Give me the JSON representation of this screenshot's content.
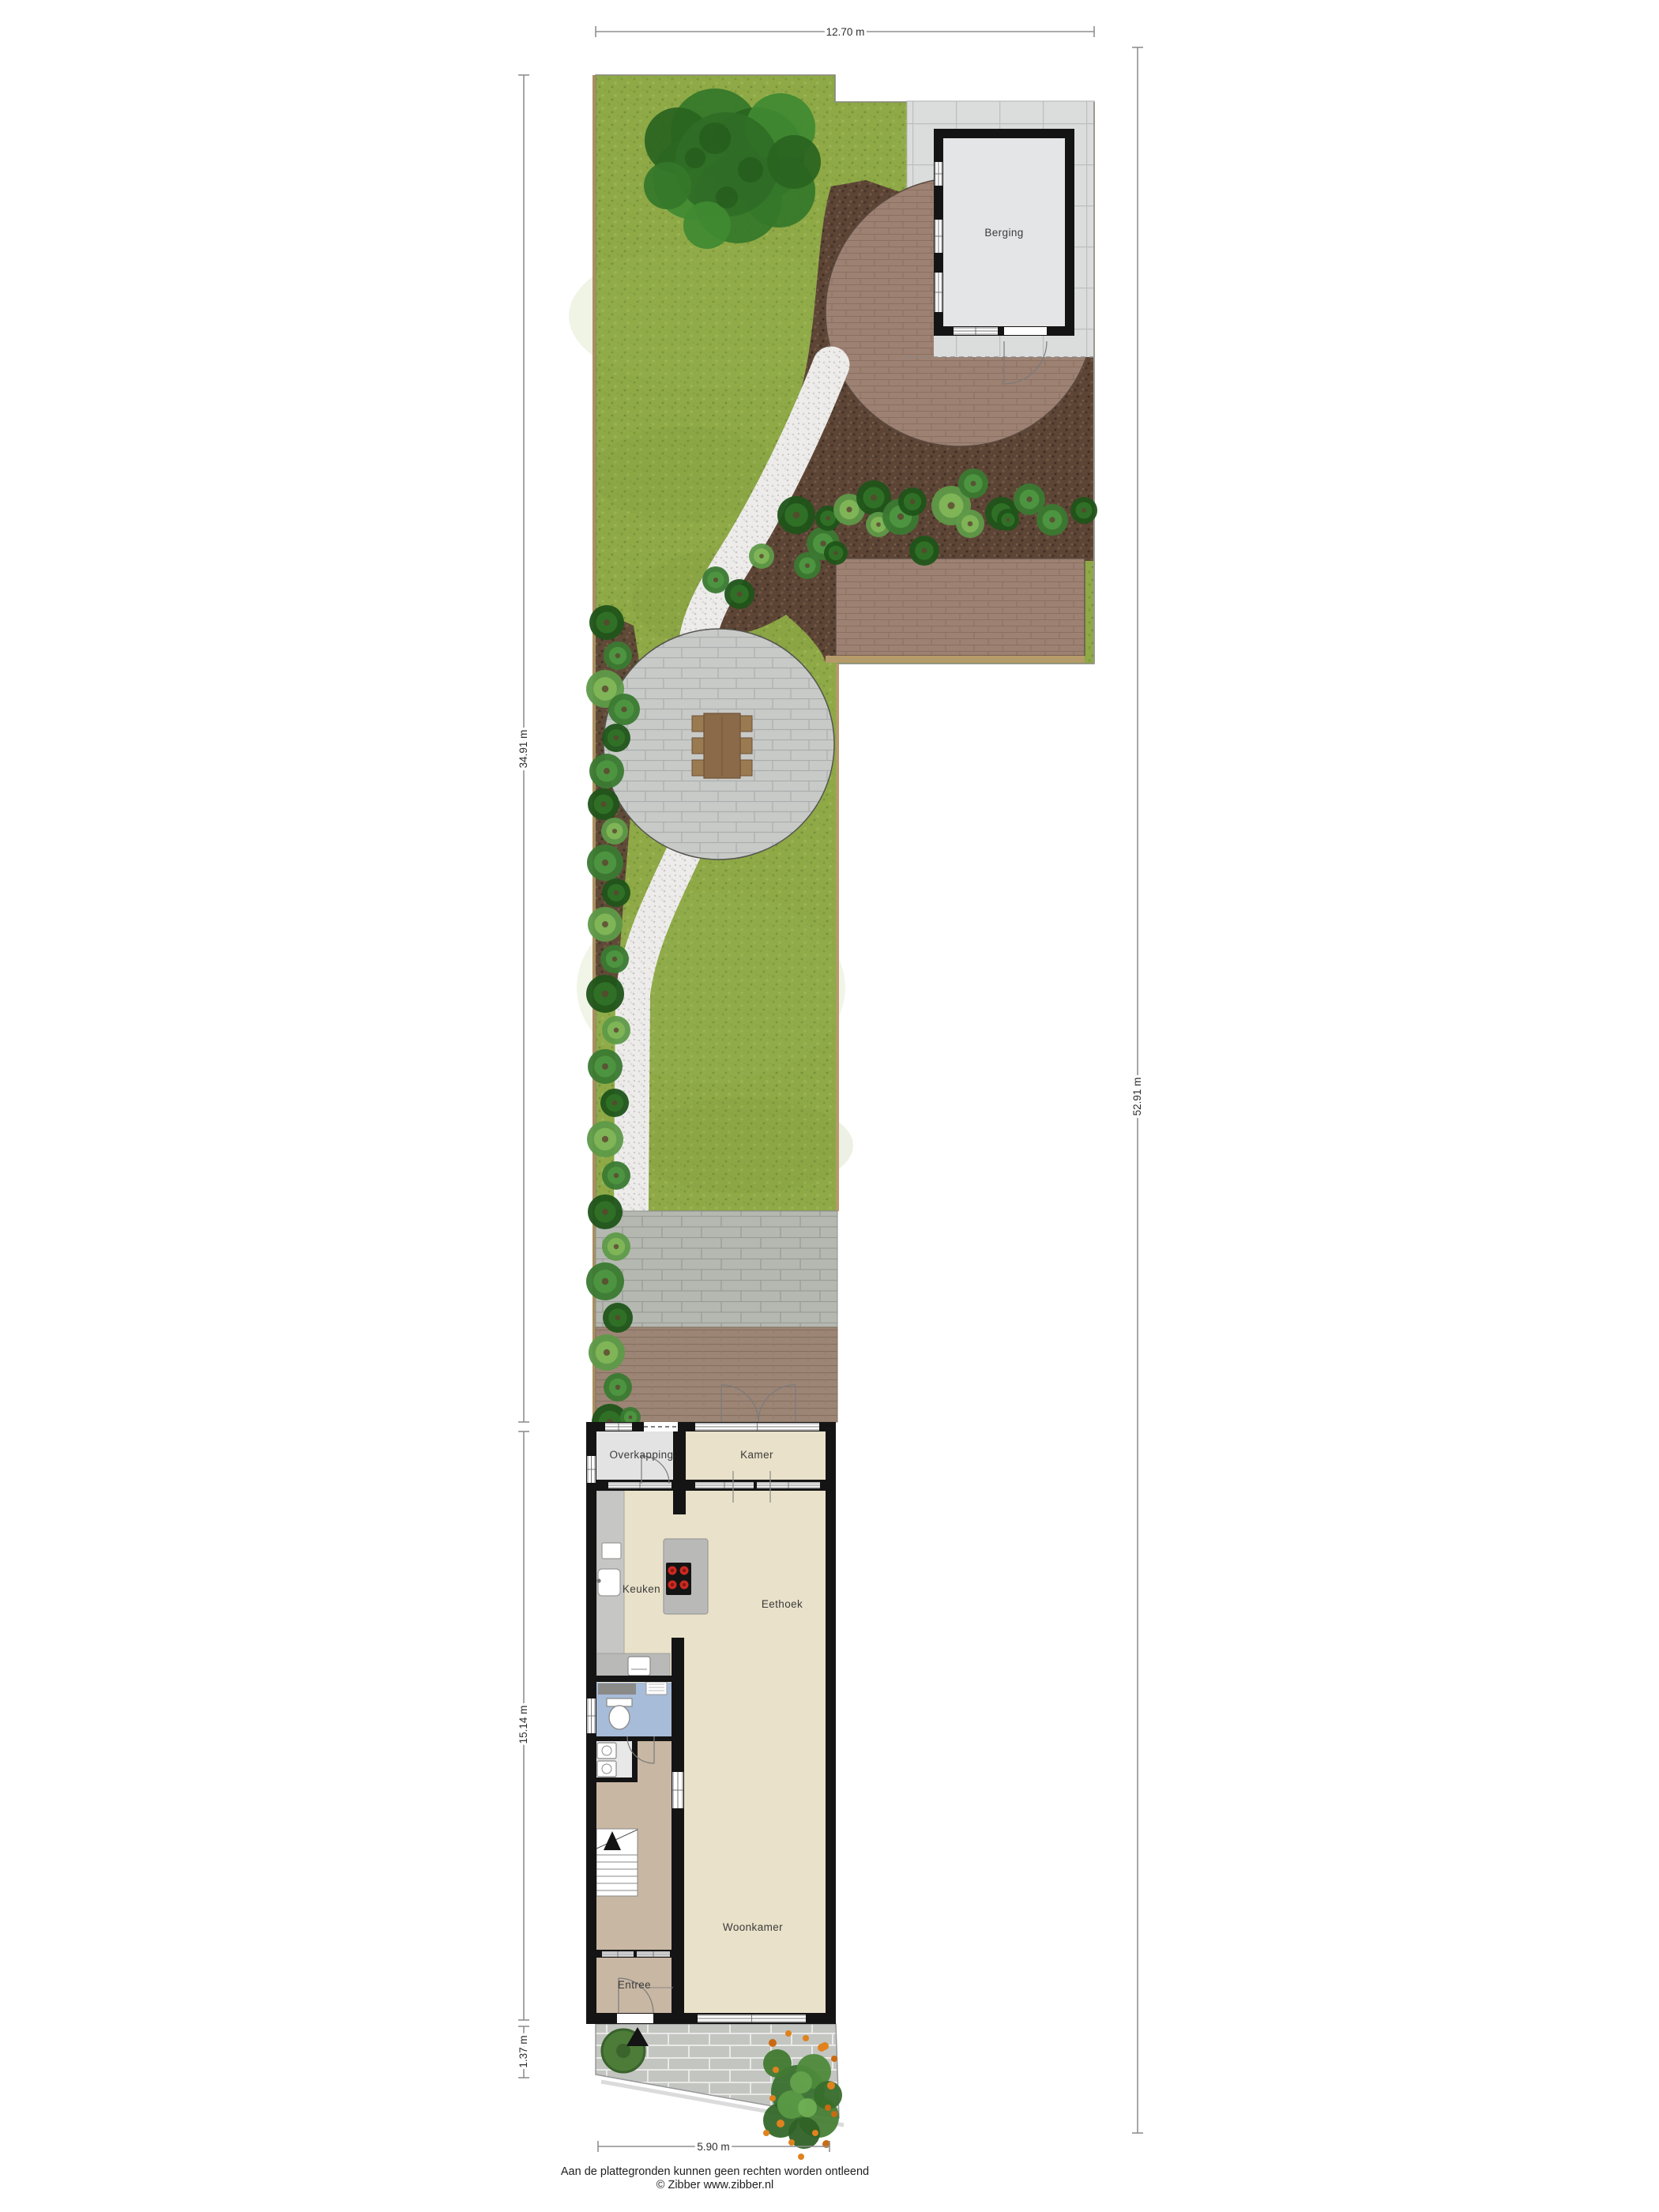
{
  "plan_title": "garden-and-ground-floor-site-plan",
  "rooms": {
    "berging": "Berging",
    "overkapping": "Overkapping",
    "kamer": "Kamer",
    "keuken": "Keuken",
    "eethoek": "Eethoek",
    "woonkamer": "Woonkamer",
    "entree": "Entree"
  },
  "dimensions": {
    "top_width": "12.70 m",
    "left_garden": "34.91 m",
    "right_total": "52.91 m",
    "left_house": "15.14 m",
    "left_front": "1.37 m",
    "bottom_width": "5.90 m"
  },
  "footer": {
    "line1": "Aan de plattegronden kunnen geen rechten worden ontleend",
    "line2": "© Zibber www.zibber.nl"
  },
  "colors": {
    "grass": "#8ea946",
    "mulch": "#5d4536",
    "brick": "#9d8172",
    "stone_circle": "#c8cac8",
    "terrace_block": "#b5b8b1",
    "front_paving": "#c3c5c1",
    "shed_tile": "#dbdddc",
    "deck": "#9d8576",
    "floor_beige": "#e9e1c9",
    "floor_hall": "#c8b7a3",
    "toilet_blue": "#a7bcd8",
    "wall": "#141414",
    "burner_red": "#cc2a22"
  }
}
